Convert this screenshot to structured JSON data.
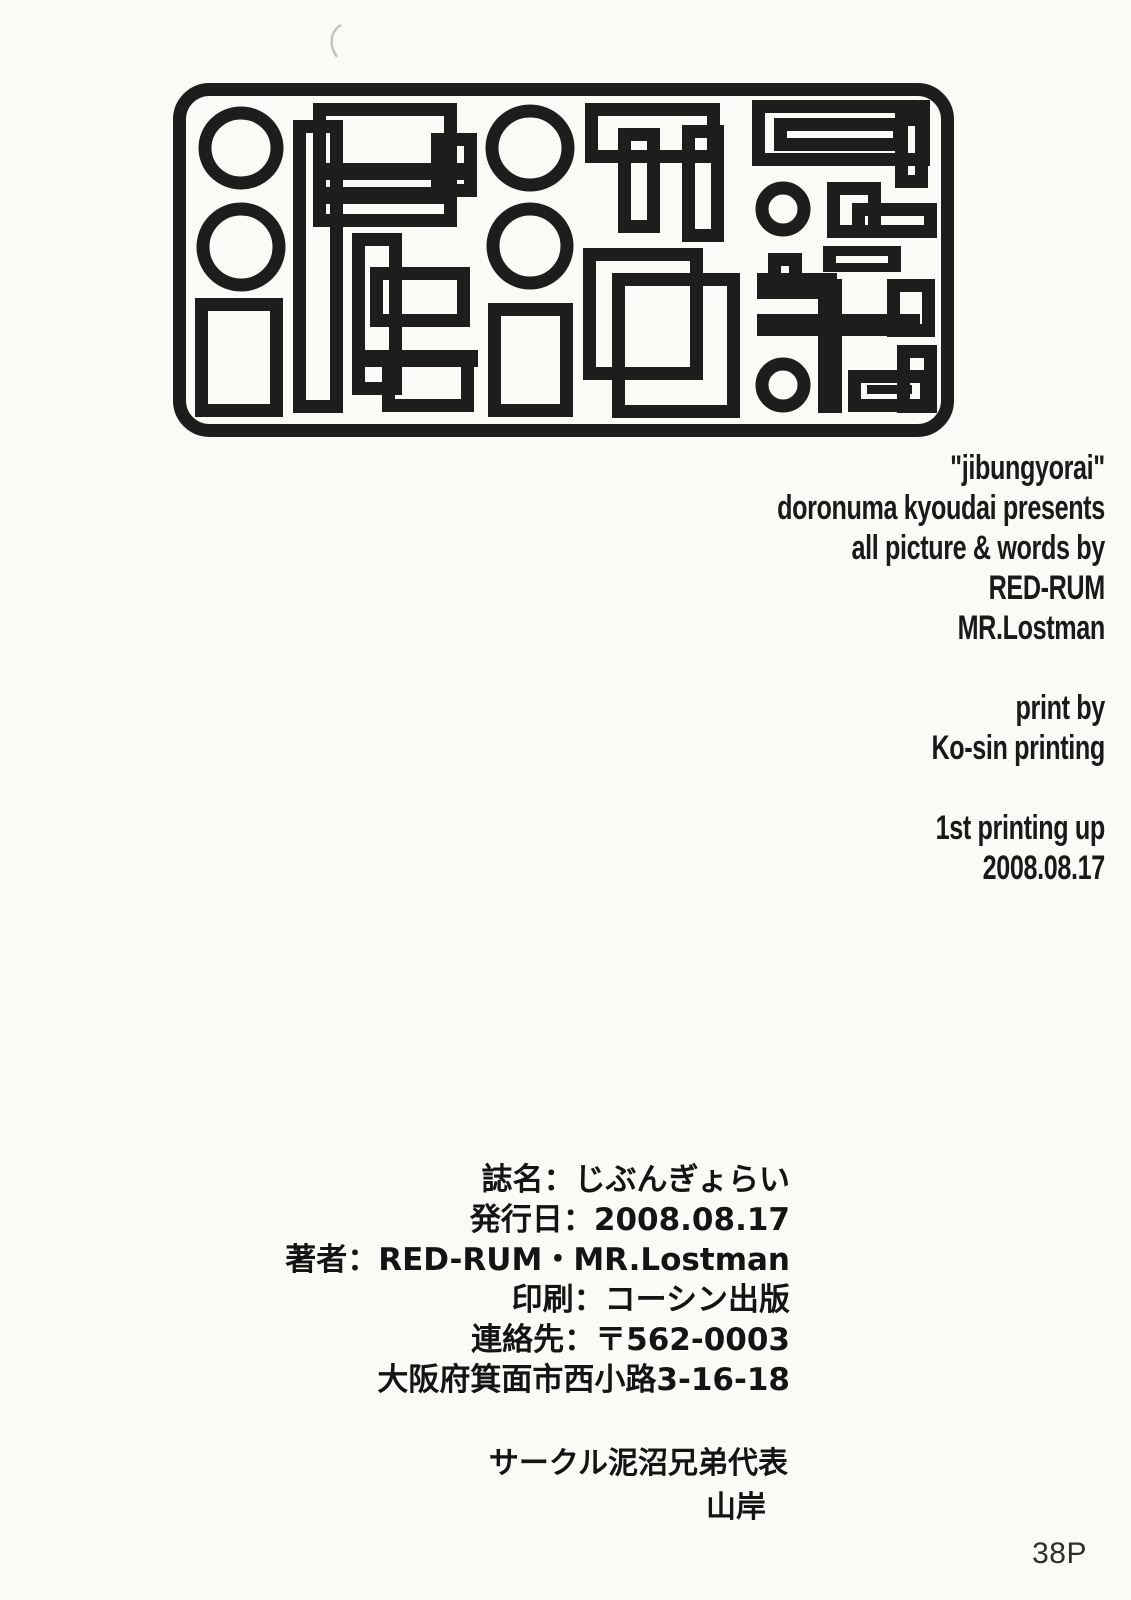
{
  "page": {
    "background_color": "#fbfaf7",
    "ink_color": "#1d1d1d",
    "page_number": "38P"
  },
  "logo": {
    "icon": "doronuma-kyoudai-geometric-logo"
  },
  "colophon_en": {
    "groups": [
      [
        "\"jibungyorai\"",
        "doronuma kyoudai presents",
        "all picture & words by",
        "RED-RUM",
        "MR.Lostman"
      ],
      [
        "print by",
        "Ko-sin printing"
      ],
      [
        "1st printing up",
        "2008.08.17"
      ]
    ]
  },
  "colophon_jp": {
    "lines": [
      "誌名：じぶんぎょらい",
      "発行日：2008.08.17",
      "著者：RED-RUM・MR.Lostman",
      "印刷：コーシン出版",
      "連絡先：〒562-0003",
      "大阪府箕面市西小路3-16-18"
    ],
    "circle_line": "サークル泥沼兄弟代表",
    "representative": "山岸"
  }
}
